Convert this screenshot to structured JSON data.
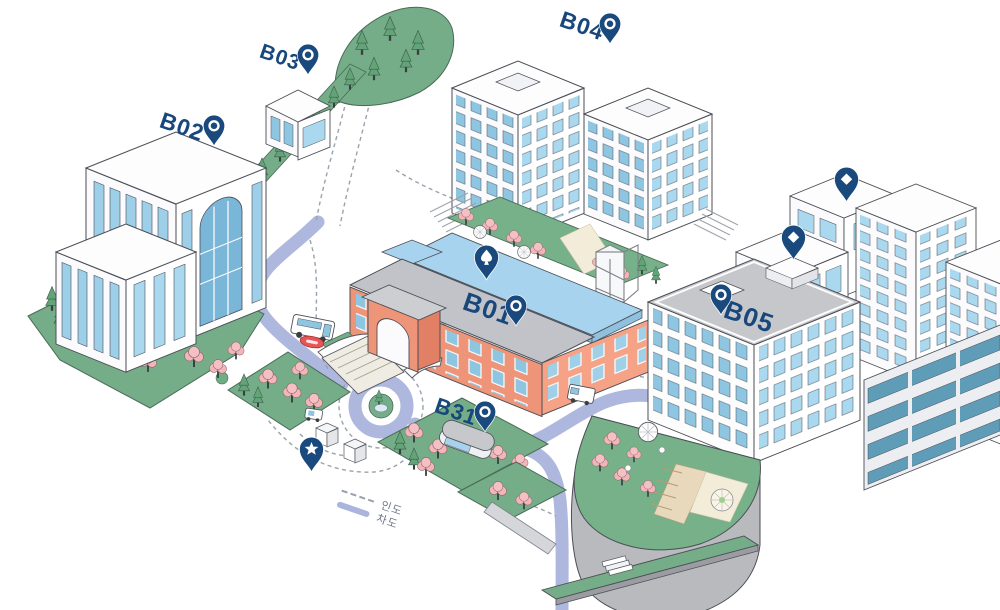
{
  "map": {
    "name": "campus-buildings-isometric-map",
    "colors": {
      "pin": "#1a4a7d",
      "label": "#17477b",
      "road": "#aeb7de",
      "grass": "#74ad87",
      "cherry": "#f2b6ba",
      "brick": "#ee9478",
      "window_blue": "#8ec6e2",
      "window_light": "#aad8ef",
      "roof_gray": "#c6c7cb",
      "flat_roof_blue": "#a7d3ee",
      "legend_dashed": "#97a0ae",
      "legend_solid": "#aab4dc"
    },
    "building_labels": [
      {
        "id": "B02",
        "label_x": 182,
        "label_y": 127,
        "pin_x": 214,
        "pin_y": 147,
        "size": 23
      },
      {
        "id": "B03",
        "label_x": 280,
        "label_y": 58,
        "pin_x": 308,
        "pin_y": 76,
        "size": 21
      },
      {
        "id": "B04",
        "label_x": 582,
        "label_y": 26,
        "pin_x": 610,
        "pin_y": 45,
        "size": 23
      },
      {
        "id": "B01",
        "label_x": 488,
        "label_y": 309,
        "pin_x": 516,
        "pin_y": 327,
        "size": 26
      },
      {
        "id": "B05",
        "label_x": 749,
        "label_y": 317,
        "pin_x": 721,
        "pin_y": 316,
        "size": 26
      },
      {
        "id": "B31",
        "label_x": 456,
        "label_y": 412,
        "pin_x": 485,
        "pin_y": 433,
        "size": 22
      }
    ],
    "poi_markers": [
      {
        "name": "courtyard-pin",
        "glyph": "spade",
        "x": 486,
        "y": 281
      },
      {
        "name": "rooftop-pin-upper",
        "glyph": "diamond",
        "x": 846,
        "y": 203
      },
      {
        "name": "rooftop-pin-lower",
        "glyph": "diamond",
        "x": 793,
        "y": 261
      },
      {
        "name": "plaza-pin",
        "glyph": "star",
        "x": 311,
        "y": 473
      }
    ],
    "legend": {
      "x": 344,
      "y": 484,
      "items": [
        {
          "label": "인도",
          "line_style": "dashed"
        },
        {
          "label": "차도",
          "line_style": "solid"
        }
      ]
    }
  }
}
